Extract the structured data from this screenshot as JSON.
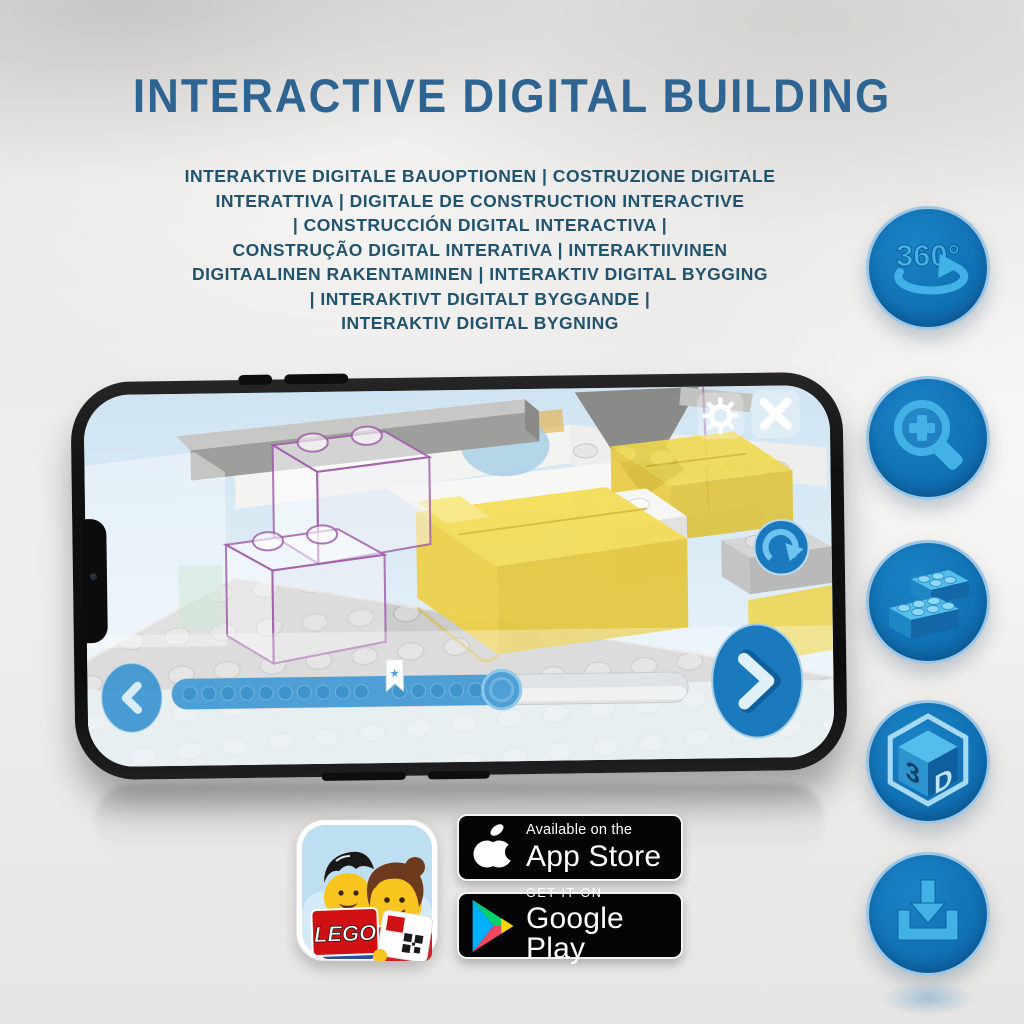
{
  "title": "INTERACTIVE DIGITAL BUILDING",
  "subtitle_lines": [
    "INTERAKTIVE DIGITALE BAUOPTIONEN | COSTRUZIONE DIGITALE",
    "INTERATTIVA | DIGITALE DE CONSTRUCTION INTERACTIVE",
    "| CONSTRUCCIÓN DIGITAL INTERACTIVA |",
    "CONSTRUÇÃO DIGITAL INTERATIVA | INTERAKTIIVINEN",
    "DIGITAALINEN RAKENTAMINEN | INTERAKTIV DIGITAL BYGGING",
    "| INTERAKTIVT DIGITALT BYGGANDE |",
    "INTERAKTIV DIGITAL BYGNING"
  ],
  "feature_icons": {
    "rotation_label": "360°",
    "cube_left": "3",
    "cube_right": "D",
    "names": [
      "360-rotation",
      "zoom-in",
      "brick-building",
      "3d-view",
      "download"
    ]
  },
  "phone_app": {
    "slider": {
      "filled_width": 327,
      "handle_x": 413,
      "flag_x": 296,
      "star": "★",
      "progress_percent": 63,
      "bookmark_percent": 41
    }
  },
  "badges": {
    "app_store": {
      "line1": "Available on the",
      "line2": "App Store"
    },
    "google_play": {
      "line1": "GET IT ON",
      "line2": "Google Play"
    },
    "lego_logo": "LEGO"
  },
  "colors": {
    "title_blue": "#2d6491",
    "subtitle_blue": "#20536e",
    "circle_blue": "#1173b6",
    "glyph_blue": "#41b1e6",
    "bed_yellow": "#f1d94b",
    "outline_purple": "#9c57a6"
  }
}
